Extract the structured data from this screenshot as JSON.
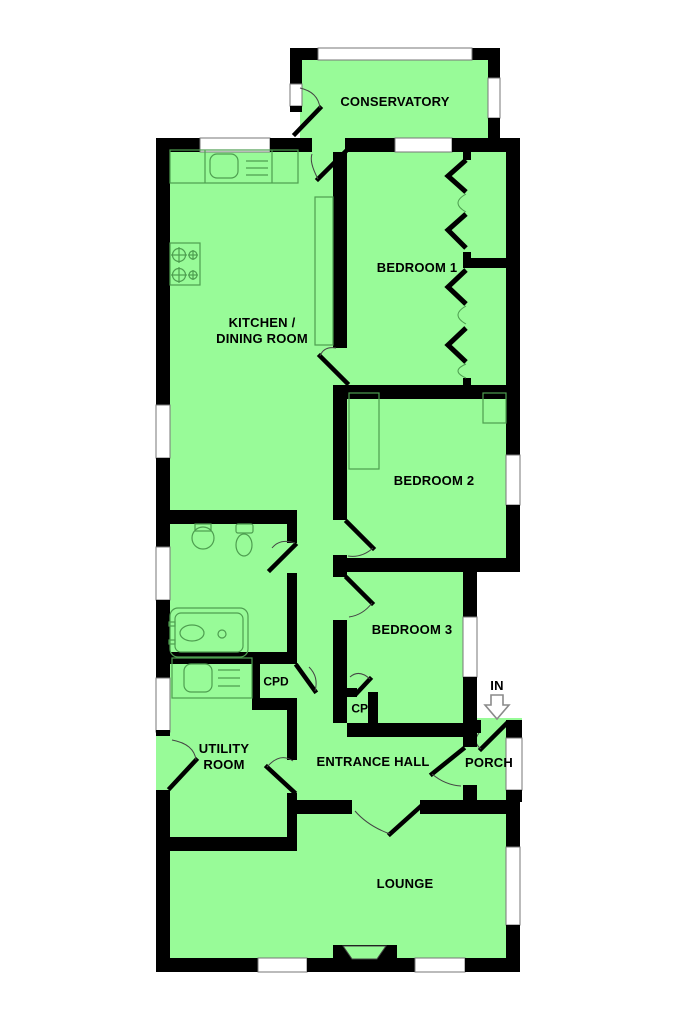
{
  "plan": {
    "rooms": {
      "conservatory": {
        "label": "CONSERVATORY"
      },
      "kitchen_dining": {
        "label": "KITCHEN /\nDINING ROOM"
      },
      "bedroom1": {
        "label": "BEDROOM 1"
      },
      "bedroom2": {
        "label": "BEDROOM 2"
      },
      "bedroom3": {
        "label": "BEDROOM 3"
      },
      "bedroom3_cupboard": {
        "label": "CPD"
      },
      "utility_cupboard": {
        "label": "CPD"
      },
      "utility": {
        "label": "UTILITY\nROOM"
      },
      "entrance_hall": {
        "label": "ENTRANCE HALL"
      },
      "porch": {
        "label": "PORCH"
      },
      "lounge": {
        "label": "LOUNGE"
      }
    },
    "entrance": {
      "label": "IN",
      "arrow_icon": "down-arrow"
    },
    "colors": {
      "floor": "#98fb98",
      "wall": "#000000",
      "window": "#ffffff",
      "window_border": "#777777",
      "fixture_line": "#4e9e50",
      "background": "#ffffff",
      "text": "#000000"
    }
  }
}
